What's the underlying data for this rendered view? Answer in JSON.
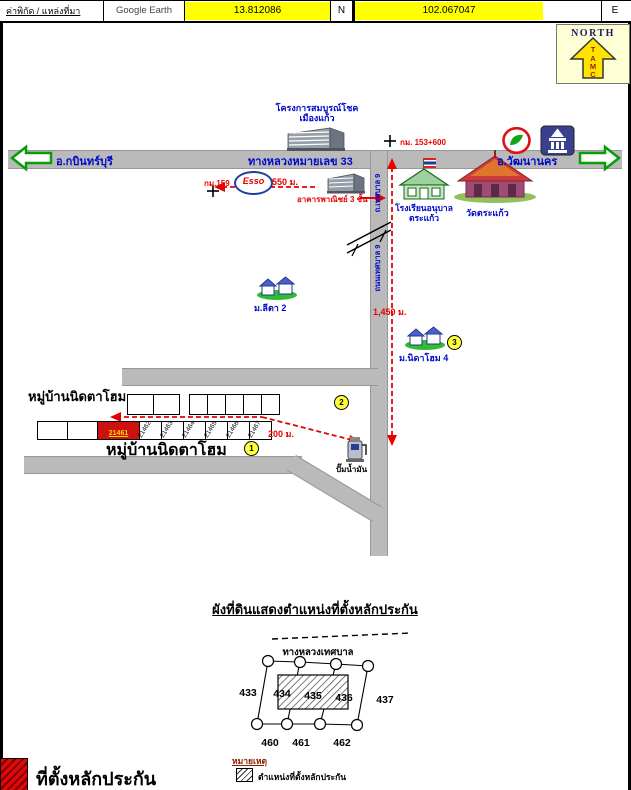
{
  "header": {
    "source_label": "ค่าพิกัด / แหล่งที่มา",
    "source_value": "Google Earth",
    "latitude": "13.812086",
    "lat_unit": "N",
    "longitude": "102.067047",
    "lng_unit": "E"
  },
  "compass": {
    "title": "NORTH",
    "letters": [
      "T",
      "A",
      "M",
      "C"
    ]
  },
  "highway": {
    "name": "ทางหลวงหมายเลข 33",
    "west": "อ.กบินทร์บุรี",
    "east": "อ.วัฒนานคร",
    "km_marker": "กม. 153+600",
    "km_station": "กม.159"
  },
  "landmarks": {
    "project_line1": "โครงการสมบูรณ์โชค",
    "project_line2": "เมืองแก้ว",
    "esso": "Esso",
    "commercial": "อาคารพาณิชย์ 3 ชั้น",
    "school_line1": "โรงเรียนอนุบาล",
    "school_line2": "ตระแก้ว",
    "temple": "วัดตระแก้ว",
    "village2": "ม.ลีตา 2",
    "village4": "ม.นิดาโฮม 4",
    "fuel": "ปั๊มน้ำมัน",
    "side_road_upper": "ถ.เทศบาล 9",
    "side_road_lower": "ถนนเทศบาล 9"
  },
  "distances": {
    "d550": "550 ม.",
    "d1450": "1,450 ม.",
    "d200": "200 ม."
  },
  "village": {
    "name_top": "หมู่บ้านนิดตาโฮม",
    "name_bottom": "หมู่บ้านนิดตาโฮม",
    "red_plot": "21461",
    "plots": [
      "21462",
      "21463",
      "21464",
      "21465",
      "21466",
      "21467"
    ]
  },
  "markers": {
    "m1": "1",
    "m2": "2",
    "m3": "3"
  },
  "plan": {
    "title": "ผังที่ดินแสดงตำแหน่งที่ตั้งหลักประกัน",
    "road": "ทางหลวงเทศบาล",
    "row_top": [
      "433",
      "434",
      "435",
      "436",
      "437"
    ],
    "row_bottom": [
      "460",
      "461",
      "462"
    ],
    "note_title": "หมายเหตุ",
    "note_text": "ตำแหน่งที่ตั้งหลักประกัน"
  },
  "footer": {
    "label": "ที่ตั้งหลักประกัน"
  },
  "colors": {
    "highlight_yellow": "#ffff00",
    "road_gray": "#bababa",
    "route_red": "#e80000",
    "label_blue": "#0008c8",
    "plot_red": "#cc1111",
    "marker_yellow": "#ffff3c"
  }
}
